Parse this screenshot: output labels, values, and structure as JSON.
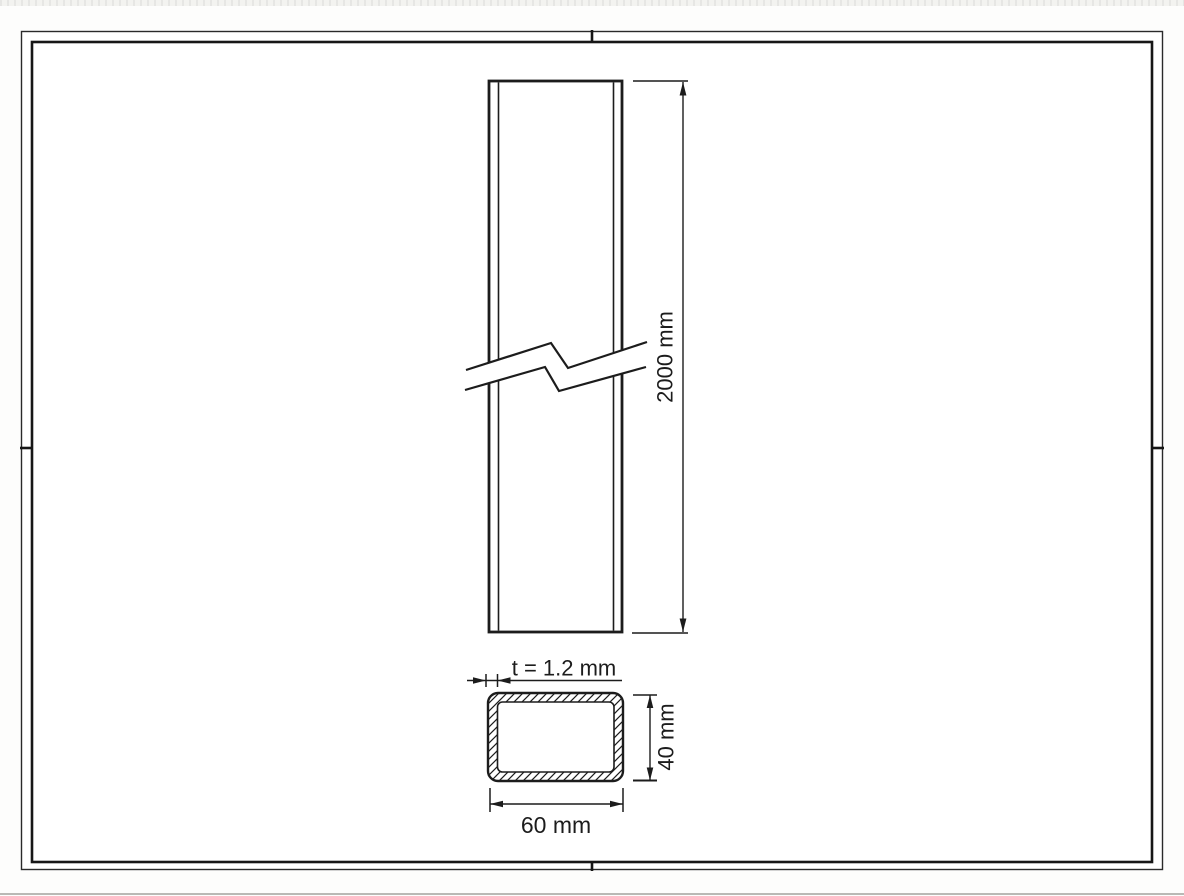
{
  "sheet": {
    "type": "technical-drawing",
    "labels": {
      "length": "2000 mm",
      "thickness": "t = 1.2 mm",
      "section_height": "40 mm",
      "section_width": "60 mm"
    },
    "colors": {
      "line": "#1c1c1c",
      "paper": "#ffffff",
      "page_background": "#fbfbf9",
      "edge_artifact": "#f1f1ee"
    }
  }
}
